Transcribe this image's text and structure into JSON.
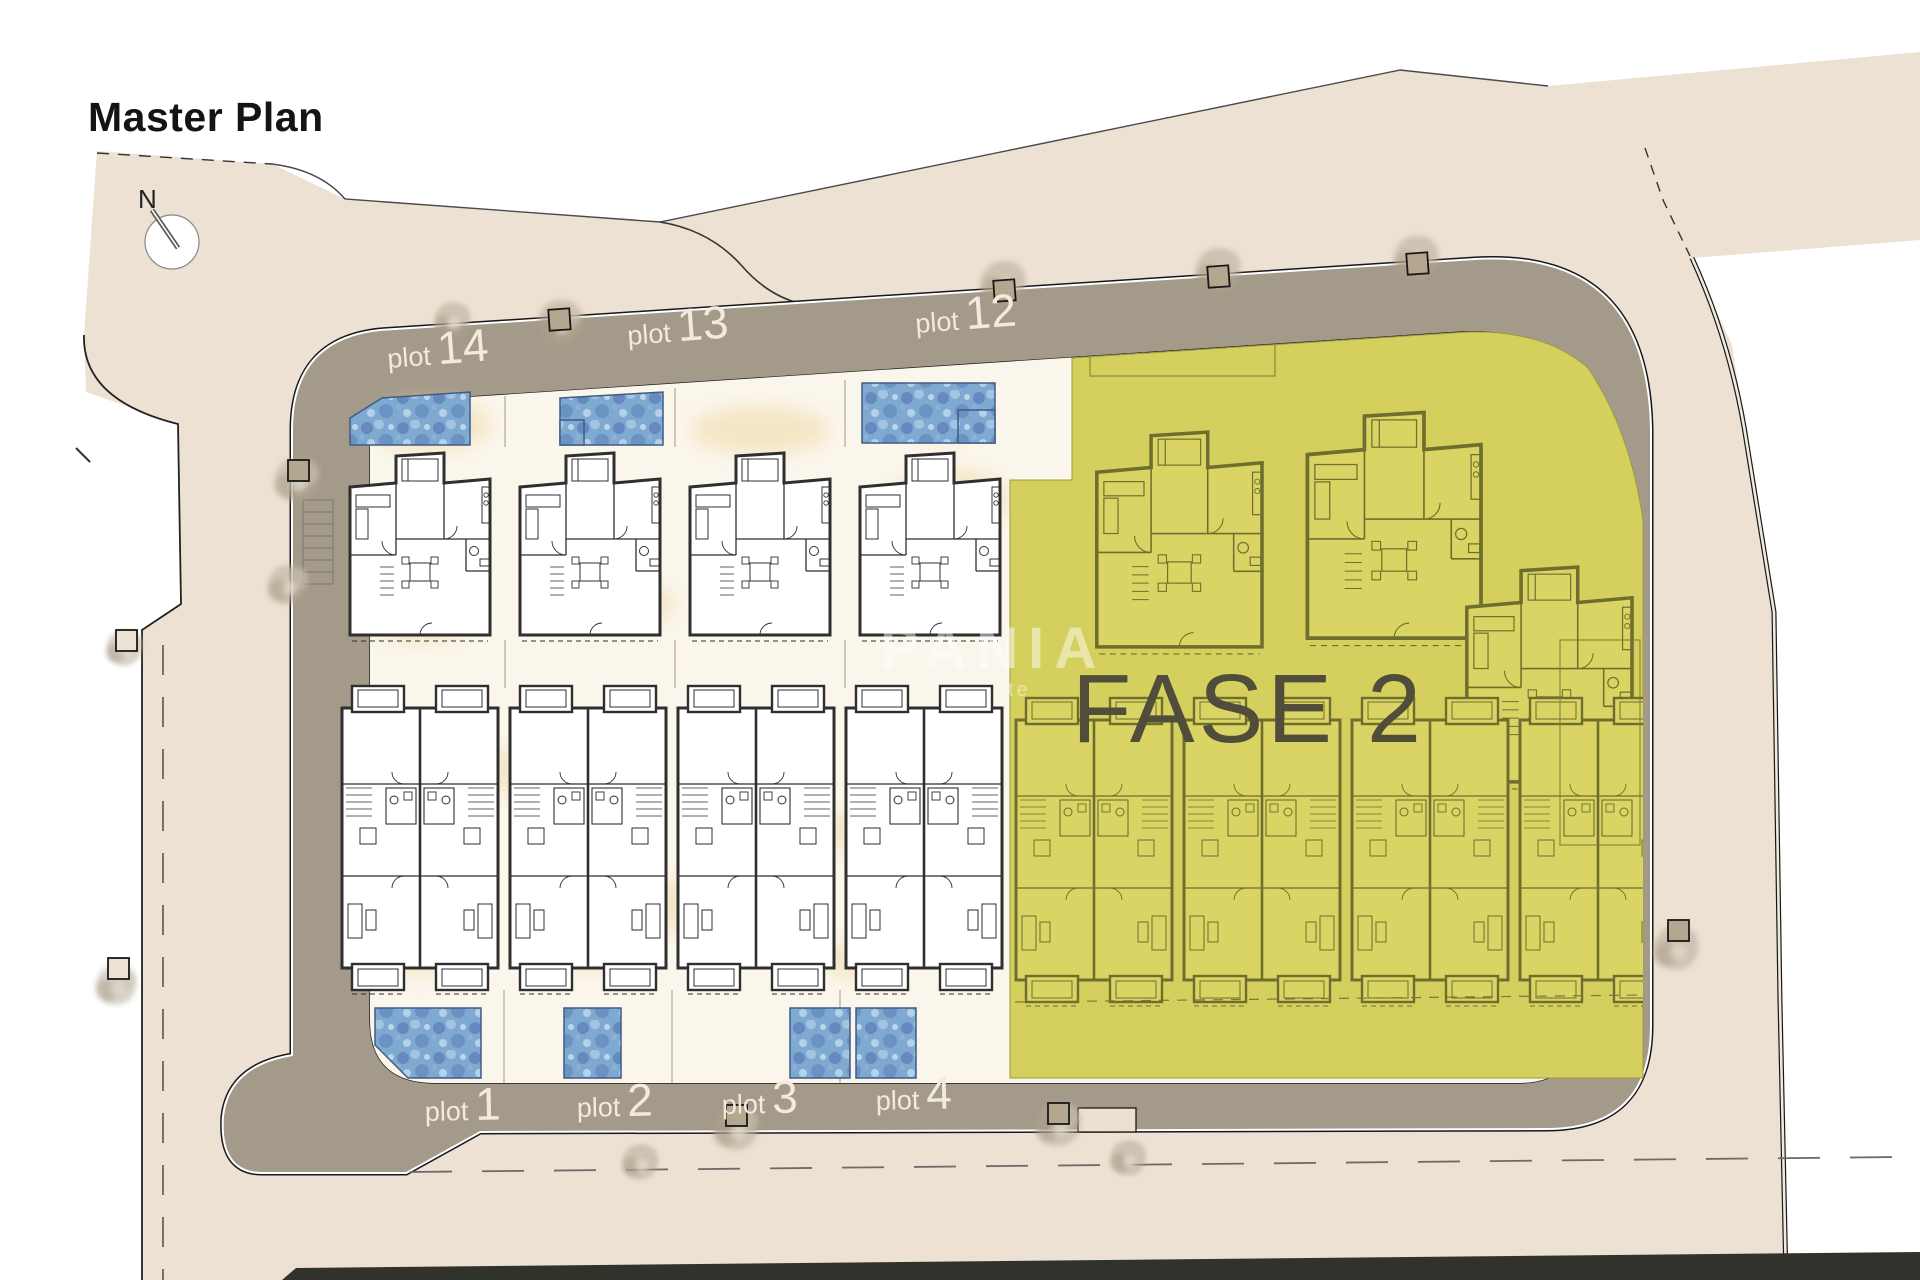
{
  "title": "Master Plan",
  "compass": {
    "label": "N"
  },
  "phase": {
    "label": "FASE 2"
  },
  "watermark": {
    "line1": "PANIA",
    "line2": "te"
  },
  "plots_top": [
    {
      "prefix": "plot",
      "number": "14"
    },
    {
      "prefix": "plot",
      "number": "13"
    },
    {
      "prefix": "plot",
      "number": "12"
    }
  ],
  "plots_bottom": [
    {
      "prefix": "plot",
      "number": "1"
    },
    {
      "prefix": "plot",
      "number": "2"
    },
    {
      "prefix": "plot",
      "number": "3"
    },
    {
      "prefix": "plot",
      "number": "4"
    }
  ],
  "colors": {
    "background": "#ffffff",
    "land": "#ece1d3",
    "road": "#a49a8a",
    "plot_ground": "#fbf6ec",
    "pool": "#7ea9d0",
    "phase_fill": "#d5d05e",
    "phase_text": "#504e3a",
    "plot_label": "#f2ebdb",
    "title": "#141414"
  }
}
